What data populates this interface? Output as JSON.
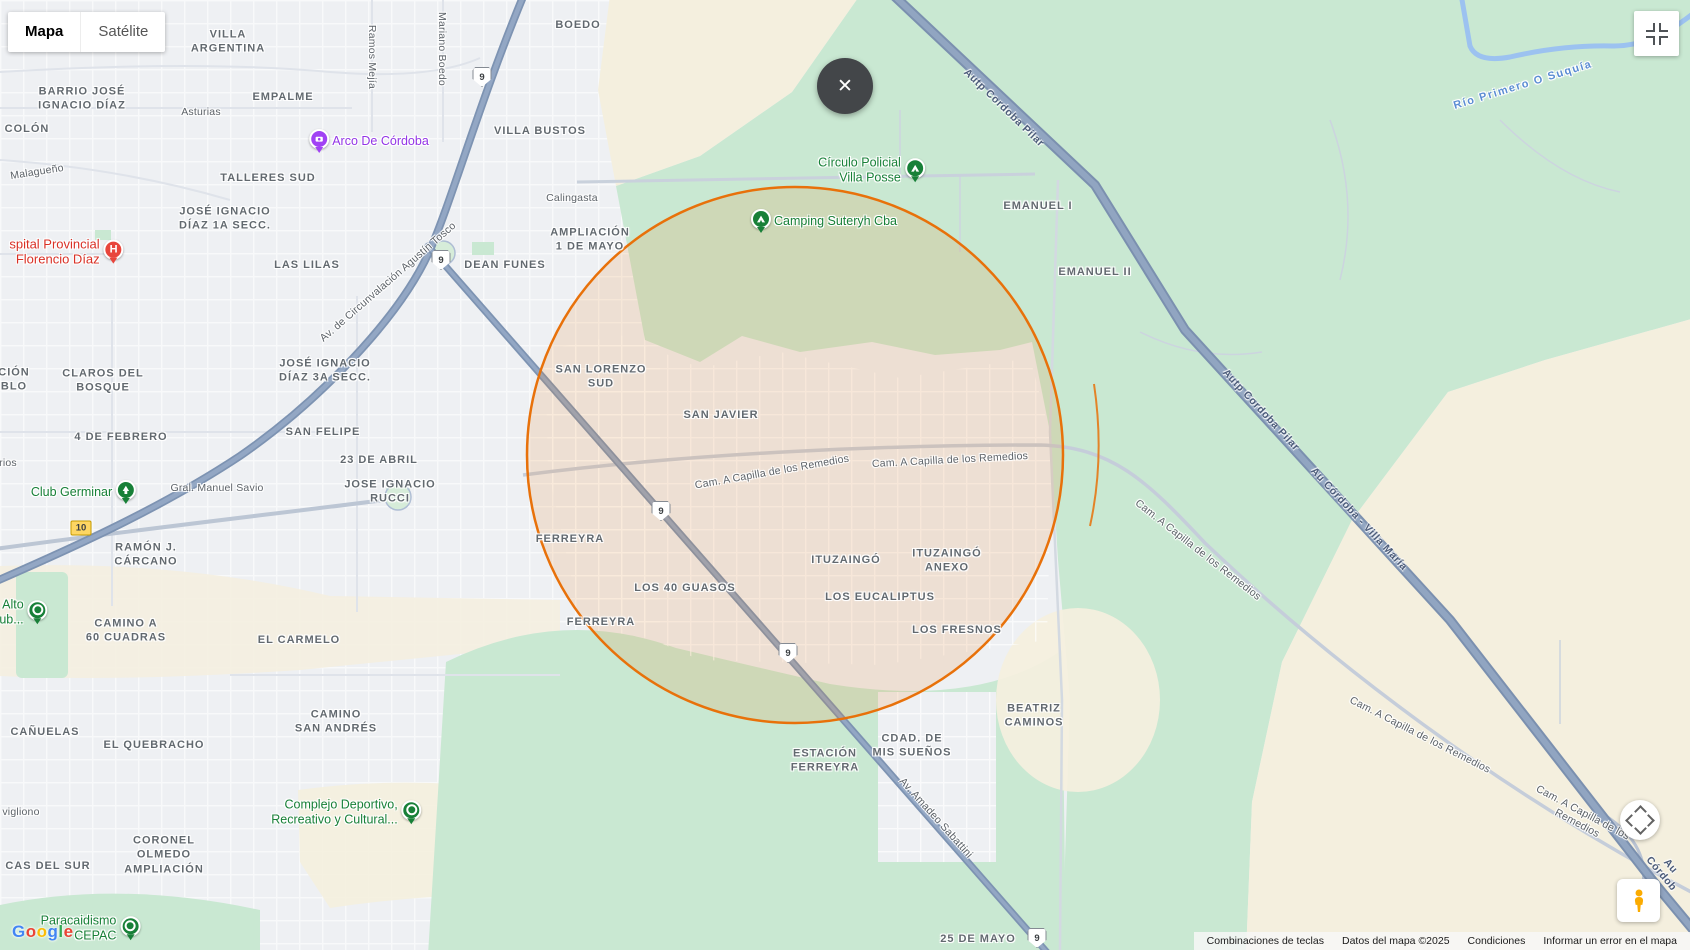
{
  "map_type_control": {
    "map_label": "Mapa",
    "satellite_label": "Satélite"
  },
  "close_button": {
    "glyph": "✕"
  },
  "google_logo": {
    "text": "Google",
    "letter_colors": [
      "#4285F4",
      "#EA4335",
      "#FBBC05",
      "#4285F4",
      "#34A853",
      "#EA4335"
    ]
  },
  "attribution": {
    "keyboard_shortcuts": "Combinaciones de teclas",
    "map_data": "Datos del mapa ©2025",
    "terms": "Condiciones",
    "report_error": "Informar un error en el mapa"
  },
  "colors": {
    "circle_stroke": "#e8710a",
    "green_area": "#c9e8d2",
    "beige_area": "#f4efde",
    "highway": "#8398b6",
    "water": "#9cc2f0",
    "poi_green": "#188038",
    "poi_purple": "#9334e6",
    "poi_red": "#d93025"
  },
  "map": {
    "labels": [
      {
        "name": "area-label-villa-argentina",
        "cls": "area",
        "text": "VILLA\nARGENTINA",
        "x": 228,
        "y": 42
      },
      {
        "name": "area-label-boedo",
        "cls": "area",
        "text": "BOEDO",
        "x": 578,
        "y": 25
      },
      {
        "name": "area-label-barrio-jose-ignacio-diaz",
        "cls": "area",
        "text": "BARRIO JOSÉ\nIGNACIO DÍAZ",
        "x": 82,
        "y": 99
      },
      {
        "name": "area-label-empalme",
        "cls": "area",
        "text": "EMPALME",
        "x": 283,
        "y": 97
      },
      {
        "name": "area-label-villa-bustos",
        "cls": "area",
        "text": "VILLA BUSTOS",
        "x": 540,
        "y": 131
      },
      {
        "name": "area-label-colon",
        "cls": "area",
        "text": "COLÓN",
        "x": 27,
        "y": 129
      },
      {
        "name": "area-label-talleres-sud",
        "cls": "area",
        "text": "TALLERES SUD",
        "x": 268,
        "y": 178
      },
      {
        "name": "area-label-jose-ignacio-diaz-1a-secc",
        "cls": "area",
        "text": "JOSÉ IGNACIO\nDÍAZ 1A SECC.",
        "x": 225,
        "y": 219
      },
      {
        "name": "area-label-ampliacion-1-de-mayo",
        "cls": "area",
        "text": "AMPLIACIÓN\n1 DE MAYO",
        "x": 590,
        "y": 240
      },
      {
        "name": "area-label-las-lilas",
        "cls": "area",
        "text": "LAS LILAS",
        "x": 307,
        "y": 265
      },
      {
        "name": "area-label-dean-funes",
        "cls": "area",
        "text": "DEAN FUNES",
        "x": 505,
        "y": 265
      },
      {
        "name": "area-label-emanuel-i",
        "cls": "area",
        "text": "EMANUEL I",
        "x": 1038,
        "y": 206
      },
      {
        "name": "area-label-emanuel-ii",
        "cls": "area",
        "text": "EMANUEL II",
        "x": 1095,
        "y": 272
      },
      {
        "name": "area-label-claros-del-bosque",
        "cls": "area",
        "text": "CLAROS DEL\nBOSQUE",
        "x": 103,
        "y": 381
      },
      {
        "name": "area-label-fragment-cion-blo",
        "cls": "area",
        "text": "CIÓN\nBLO",
        "x": 14,
        "y": 380
      },
      {
        "name": "area-label-jose-ignacio-diaz-3a-secc",
        "cls": "area",
        "text": "JOSÉ IGNACIO\nDÍAZ 3A SECC.",
        "x": 325,
        "y": 371
      },
      {
        "name": "area-label-san-lorenzo-sud",
        "cls": "area",
        "text": "SAN LORENZO\nSUD",
        "x": 601,
        "y": 377
      },
      {
        "name": "area-label-san-javier",
        "cls": "area",
        "text": "SAN JAVIER",
        "x": 721,
        "y": 415
      },
      {
        "name": "area-label-4-de-febrero",
        "cls": "area",
        "text": "4 DE FEBRERO",
        "x": 121,
        "y": 437
      },
      {
        "name": "area-label-san-felipe",
        "cls": "area",
        "text": "SAN FELIPE",
        "x": 323,
        "y": 432
      },
      {
        "name": "area-label-23-de-abril",
        "cls": "area",
        "text": "23 DE ABRIL",
        "x": 379,
        "y": 460
      },
      {
        "name": "area-label-jose-ignacio-rucci",
        "cls": "area",
        "text": "JOSE IGNACIO\nRUCCI",
        "x": 390,
        "y": 492
      },
      {
        "name": "area-label-ramon-j-carcano",
        "cls": "area",
        "text": "RAMÓN J.\nCÁRCANO",
        "x": 146,
        "y": 555
      },
      {
        "name": "area-label-ferreyra-norte",
        "cls": "area",
        "text": "FERREYRA",
        "x": 570,
        "y": 539
      },
      {
        "name": "area-label-los-40-guasos",
        "cls": "area",
        "text": "LOS 40 GUASOS",
        "x": 685,
        "y": 588
      },
      {
        "name": "area-label-ituzaingo",
        "cls": "area",
        "text": "ITUZAINGÓ",
        "x": 846,
        "y": 560
      },
      {
        "name": "area-label-ituzaingo-anexo",
        "cls": "area",
        "text": "ITUZAINGÓ\nANEXO",
        "x": 947,
        "y": 561
      },
      {
        "name": "area-label-los-eucaliptus",
        "cls": "area",
        "text": "LOS EUCALIPTUS",
        "x": 880,
        "y": 597
      },
      {
        "name": "area-label-ferreyra-sur",
        "cls": "area",
        "text": "FERREYRA",
        "x": 601,
        "y": 622
      },
      {
        "name": "area-label-los-fresnos",
        "cls": "area",
        "text": "LOS FRESNOS",
        "x": 957,
        "y": 630
      },
      {
        "name": "area-label-camino-a-60-cuadras",
        "cls": "area",
        "text": "CAMINO A\n60 CUADRAS",
        "x": 126,
        "y": 631
      },
      {
        "name": "area-label-el-carmelo",
        "cls": "area",
        "text": "EL CARMELO",
        "x": 299,
        "y": 640
      },
      {
        "name": "area-label-canuelas",
        "cls": "area",
        "text": "CAÑUELAS",
        "x": 45,
        "y": 732
      },
      {
        "name": "area-label-el-quebracho",
        "cls": "area",
        "text": "EL QUEBRACHO",
        "x": 154,
        "y": 745
      },
      {
        "name": "area-label-camino-san-andres",
        "cls": "area",
        "text": "CAMINO\nSAN ANDRÉS",
        "x": 336,
        "y": 722
      },
      {
        "name": "area-label-beatriz-caminos",
        "cls": "area",
        "text": "BEATRIZ\nCAMINOS",
        "x": 1034,
        "y": 716
      },
      {
        "name": "area-label-cdad-de-mis-suenos",
        "cls": "area",
        "text": "CDAD. DE\nMIS SUEÑOS",
        "x": 912,
        "y": 746
      },
      {
        "name": "area-label-estacion-ferreyra",
        "cls": "area",
        "text": "ESTACIÓN\nFERREYRA",
        "x": 825,
        "y": 761
      },
      {
        "name": "area-label-coronel-olmedo-ampliacion",
        "cls": "area",
        "text": "CORONEL\nOLMEDO\nAMPLIACIÓN",
        "x": 164,
        "y": 855
      },
      {
        "name": "area-label-fragment-cas-del-sur",
        "cls": "area",
        "text": "CAS DEL SUR",
        "x": 48,
        "y": 866
      },
      {
        "name": "area-label-25-de-mayo",
        "cls": "area",
        "text": "25 DE MAYO",
        "x": 978,
        "y": 939
      },
      {
        "name": "street-label-asturias",
        "cls": "street",
        "text": "Asturias",
        "x": 201,
        "y": 112
      },
      {
        "name": "street-label-ramos-mejia",
        "cls": "street",
        "text": "Ramos Mejía",
        "x": 372,
        "y": 57,
        "rot": 90
      },
      {
        "name": "street-label-mariano-boedo",
        "cls": "street",
        "text": "Mariano Boedo",
        "x": 442,
        "y": 49,
        "rot": 90
      },
      {
        "name": "street-label-calingasta",
        "cls": "street",
        "text": "Calingasta",
        "x": 572,
        "y": 198
      },
      {
        "name": "street-label-malagueno",
        "cls": "street",
        "text": "Malagueño",
        "x": 37,
        "y": 172,
        "rot": -9
      },
      {
        "name": "street-label-gral-manuel-savio",
        "cls": "street",
        "text": "Gral. Manuel Savio",
        "x": 217,
        "y": 488
      },
      {
        "name": "street-label-fragment-rios",
        "cls": "street",
        "text": "rios",
        "x": 8,
        "y": 463
      },
      {
        "name": "street-label-fragment-vigliono",
        "cls": "street",
        "text": "vigliono",
        "x": 21,
        "y": 812
      },
      {
        "name": "street-label-cam-a-capilla-de-los-remedios-1",
        "cls": "street",
        "text": "Cam. A Capilla de los Remedios",
        "x": 772,
        "y": 472,
        "rot": -10
      },
      {
        "name": "street-label-cam-a-capilla-de-los-remedios-2",
        "cls": "street",
        "text": "Cam. A Capilla de los Remedios",
        "x": 950,
        "y": 460,
        "rot": -3
      },
      {
        "name": "street-label-cam-a-capilla-de-los-remedios-3",
        "cls": "street",
        "text": "Cam. A Capilla de los Remedios",
        "x": 1198,
        "y": 550,
        "rot": 38
      },
      {
        "name": "street-label-cam-a-capilla-de-los-remedios-4",
        "cls": "street",
        "text": "Cam. A Capilla de los Remedios",
        "x": 1420,
        "y": 735,
        "rot": 27
      },
      {
        "name": "street-label-cam-a-capilla-de-los-remedios-5",
        "cls": "street",
        "text": "Cam. A Capilla de los Remedios",
        "x": 1580,
        "y": 818,
        "rot": 28
      },
      {
        "name": "street-label-av-amadeo-sabattini",
        "cls": "street",
        "text": "Av. Amadeo Sabattini",
        "x": 936,
        "y": 818,
        "rot": 48
      },
      {
        "name": "street-label-av-de-circunvalacion-agustin-tosco",
        "cls": "street",
        "text": "Av. de Circunvalación Agustín Tosco",
        "x": 388,
        "y": 282,
        "rot": -41
      },
      {
        "name": "highway-label-autp-cordoba-pilar-1",
        "cls": "hwy",
        "text": "Autp Cordoba Pilar",
        "x": 1004,
        "y": 108,
        "rot": 44
      },
      {
        "name": "highway-label-autp-cordoba-pilar-2",
        "cls": "hwy",
        "text": "Autp Cordoba Pilar",
        "x": 1261,
        "y": 410,
        "rot": 47
      },
      {
        "name": "highway-label-au-cordoba-villa-maria",
        "cls": "hwy",
        "text": "Au Córdoba - Villa María",
        "x": 1359,
        "y": 519,
        "rot": 47
      },
      {
        "name": "highway-label-au-cordoba-fragment",
        "cls": "hwy",
        "text": "Au Córdob",
        "x": 1666,
        "y": 870,
        "rot": 50
      },
      {
        "name": "water-label-rio-primero-o-suquia",
        "cls": "water",
        "text": "Río Primero O Suquía",
        "x": 1523,
        "y": 85,
        "rot": -17
      }
    ],
    "pois": [
      {
        "name": "poi-hospital-provincial-florencio-diaz",
        "text": "spital Provincial\nFlorencio Díaz",
        "icon": "hospital",
        "side": "right",
        "color": "red",
        "x": 66,
        "y": 252,
        "align": "right"
      },
      {
        "name": "poi-arco-de-cordoba",
        "text": "Arco De Córdoba",
        "icon": "camera",
        "side": "left",
        "color": "purple",
        "x": 369,
        "y": 141,
        "align": "left"
      },
      {
        "name": "poi-circulo-policial-villa-posse",
        "text": "Círculo Policial\nVilla Posse",
        "icon": "tent",
        "side": "right",
        "color": "green",
        "x": 871,
        "y": 170,
        "align": "right"
      },
      {
        "name": "poi-camping-suteryh-cba",
        "text": "Camping Suteryh Cba",
        "icon": "tent",
        "side": "left",
        "color": "green",
        "x": 824,
        "y": 221,
        "align": "left"
      },
      {
        "name": "poi-club-germinar",
        "text": "Club Germinar",
        "icon": "tree",
        "side": "right",
        "color": "green",
        "x": 83,
        "y": 492,
        "align": "right"
      },
      {
        "name": "poi-alto-club",
        "text": "Alto\nub...",
        "icon": "pin",
        "side": "right",
        "color": "green",
        "x": 23,
        "y": 612,
        "align": "right"
      },
      {
        "name": "poi-complejo-deportivo-recreativo-y-cultural",
        "text": "Complejo Deportivo,\nRecreativo y Cultural...",
        "icon": "pin",
        "side": "right",
        "color": "green",
        "x": 346,
        "y": 812,
        "align": "right"
      },
      {
        "name": "poi-paracaidismo-cepac",
        "text": "Paracaidismo\nCEPAC",
        "icon": "pin",
        "side": "right",
        "color": "green",
        "x": 90,
        "y": 928,
        "align": "right"
      }
    ],
    "route_shields": [
      {
        "label": "9",
        "x": 482,
        "y": 77,
        "variant": "white"
      },
      {
        "label": "9",
        "x": 441,
        "y": 260,
        "variant": "white"
      },
      {
        "label": "9",
        "x": 661,
        "y": 511,
        "variant": "white"
      },
      {
        "label": "9",
        "x": 788,
        "y": 653,
        "variant": "white"
      },
      {
        "label": "9",
        "x": 1037,
        "y": 938,
        "variant": "white"
      },
      {
        "label": "10",
        "x": 81,
        "y": 528,
        "variant": "yellow"
      }
    ]
  }
}
